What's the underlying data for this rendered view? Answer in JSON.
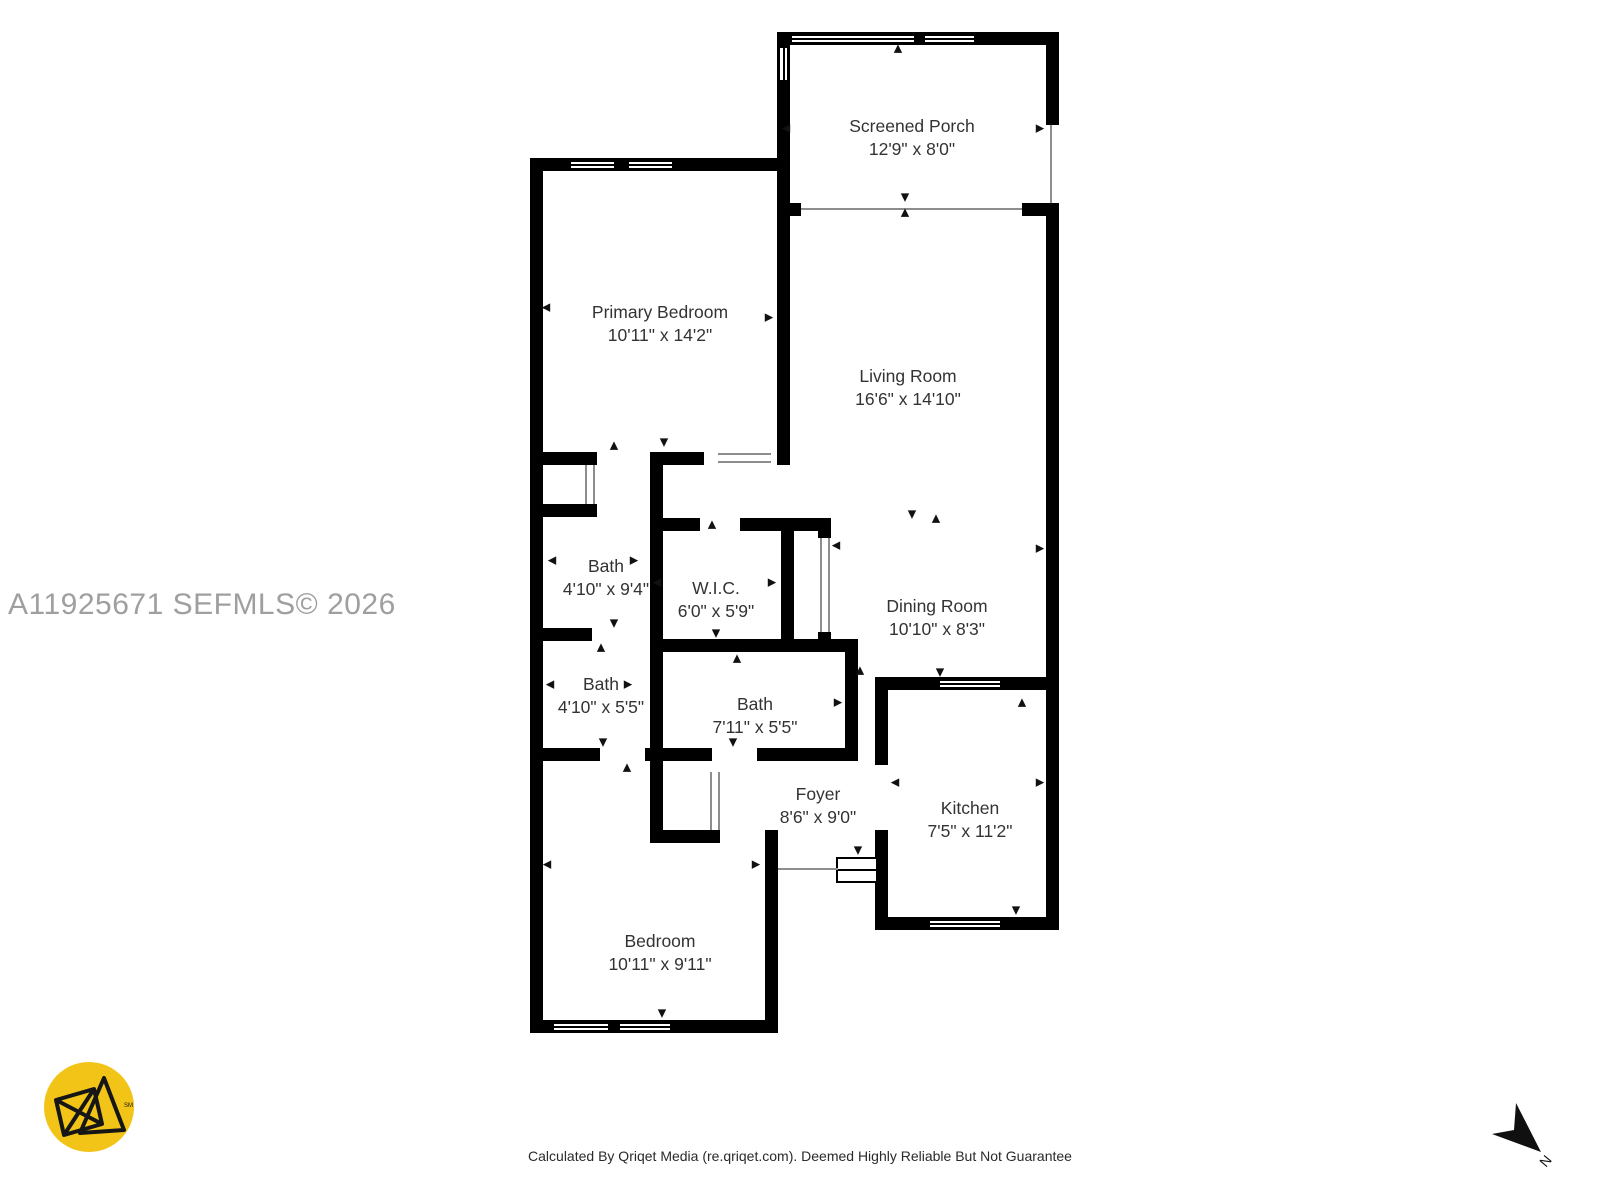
{
  "title": "Floor plan",
  "watermark": "A11925671  SEFMLS© 2026",
  "footer": "Calculated By Qriqet Media (re.qriqet.com). Deemed Highly Reliable But Not Guarantee",
  "compass": {
    "label": "N"
  },
  "logo": {
    "alt": "Qriqet Media logo",
    "trademark": "SM",
    "background": "#F2C417",
    "mark_color": "#161616"
  },
  "colors": {
    "wall": "#000000",
    "room_label": "#333333",
    "watermark": "#9F9F9F",
    "footer_text": "#2A2A2A"
  },
  "rooms": [
    {
      "name": "Screened Porch",
      "dims": "12'9\" x 8'0\"",
      "cx": 912,
      "cy": 138
    },
    {
      "name": "Primary Bedroom",
      "dims": "10'11\" x 14'2\"",
      "cx": 660,
      "cy": 324
    },
    {
      "name": "Living Room",
      "dims": "16'6\" x 14'10\"",
      "cx": 908,
      "cy": 388
    },
    {
      "name": "Bath",
      "dims": "4'10\" x 9'4\"",
      "cx": 606,
      "cy": 578
    },
    {
      "name": "W.I.C.",
      "dims": "6'0\" x 5'9\"",
      "cx": 716,
      "cy": 600
    },
    {
      "name": "Dining Room",
      "dims": "10'10\" x 8'3\"",
      "cx": 937,
      "cy": 618
    },
    {
      "name": "Bath",
      "dims": "4'10\" x 5'5\"",
      "cx": 601,
      "cy": 696
    },
    {
      "name": "Bath",
      "dims": "7'11\" x 5'5\"",
      "cx": 755,
      "cy": 716
    },
    {
      "name": "Foyer",
      "dims": "8'6\" x 9'0\"",
      "cx": 818,
      "cy": 806
    },
    {
      "name": "Kitchen",
      "dims": "7'5\" x 11'2\"",
      "cx": 970,
      "cy": 820
    },
    {
      "name": "Bedroom",
      "dims": "10'11\" x 9'11\"",
      "cx": 660,
      "cy": 953
    }
  ]
}
